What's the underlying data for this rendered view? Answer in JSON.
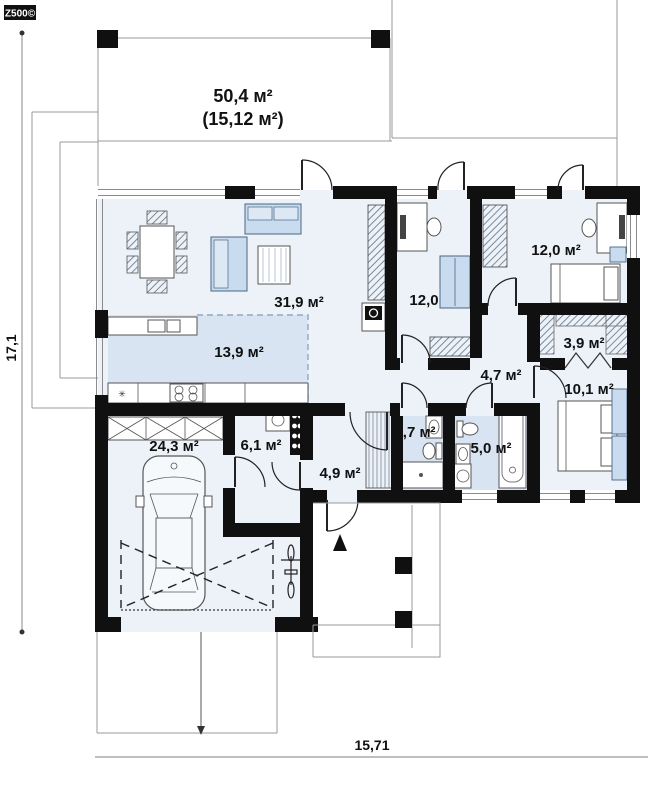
{
  "logo": {
    "text": "Z500©"
  },
  "dimensions": {
    "height": "17,1",
    "width": "15,71"
  },
  "terrace": {
    "area": "50,4 м²",
    "area_secondary": "(15,12 м²)"
  },
  "rooms": {
    "living_room": {
      "area": "31,9 м²"
    },
    "kitchen": {
      "area": "13,9 м²"
    },
    "office": {
      "area": "12,0"
    },
    "bedroom_top": {
      "area": "12,0 м²"
    },
    "wardrobe": {
      "area": "3,9 м²"
    },
    "hall": {
      "area": "4,7 м²"
    },
    "bedroom_right": {
      "area": "10,1 м²"
    },
    "wc": {
      "area": "2,7 м²"
    },
    "bathroom": {
      "area": "5,0 м²"
    },
    "entry_hall": {
      "area": "4,9 м²"
    },
    "utility": {
      "area": "6,1 м²"
    },
    "garage": {
      "area": "24,3 м²"
    }
  },
  "appliances": {
    "washing_machine": "Ст.М"
  },
  "icons": {
    "fridge": "✳"
  },
  "colors": {
    "wall": "#101010",
    "room_fill": "#edf2f9",
    "wet_floor_fill": "#d9e4f2",
    "furniture_fill": "#c9dbee",
    "line": "#999999"
  }
}
